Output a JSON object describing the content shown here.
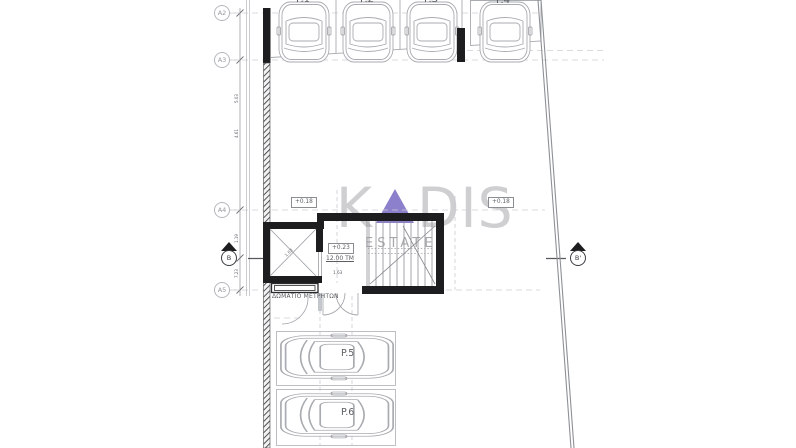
{
  "drawing": {
    "grid_bubbles": [
      {
        "label": "A2"
      },
      {
        "label": "A3"
      },
      {
        "label": "A4"
      },
      {
        "label": "A5"
      }
    ],
    "section_markers": {
      "left": "B",
      "right": "B'"
    },
    "levels": {
      "left": "+0.18",
      "right": "+0.18",
      "stair_lobby": "+0.23"
    },
    "areas": {
      "stair_lobby": "12.00 TM"
    },
    "rooms": {
      "meter_room": "ΔΩΜΑΤΙΟ ΜΕΤΡΗΤΩΝ"
    },
    "parking_labels": {
      "top": [
        {
          "label": "P.1"
        },
        {
          "label": "P.2"
        },
        {
          "label": "P.3"
        },
        {
          "label": "P.4"
        }
      ],
      "bottom": [
        {
          "label": "P.5"
        },
        {
          "label": "P.6"
        }
      ]
    },
    "dimensions": {
      "axis": [
        {
          "value": "5.03"
        },
        {
          "value": "4.61"
        },
        {
          "value": "1.19"
        },
        {
          "value": "7.23"
        }
      ],
      "elevator_width": "1.03",
      "lobby_width": "1.63"
    }
  },
  "watermark": {
    "prefix": "K",
    "suffix": "DIS",
    "subtitle": "ESTATES",
    "triangle_color": "#7c6dc4",
    "text_color": "#b2b2b6"
  },
  "colors": {
    "wall": "#1d1d1f",
    "line": "#9a9da3",
    "light_line": "#cdd0d5",
    "boundary": "#8d9096"
  }
}
